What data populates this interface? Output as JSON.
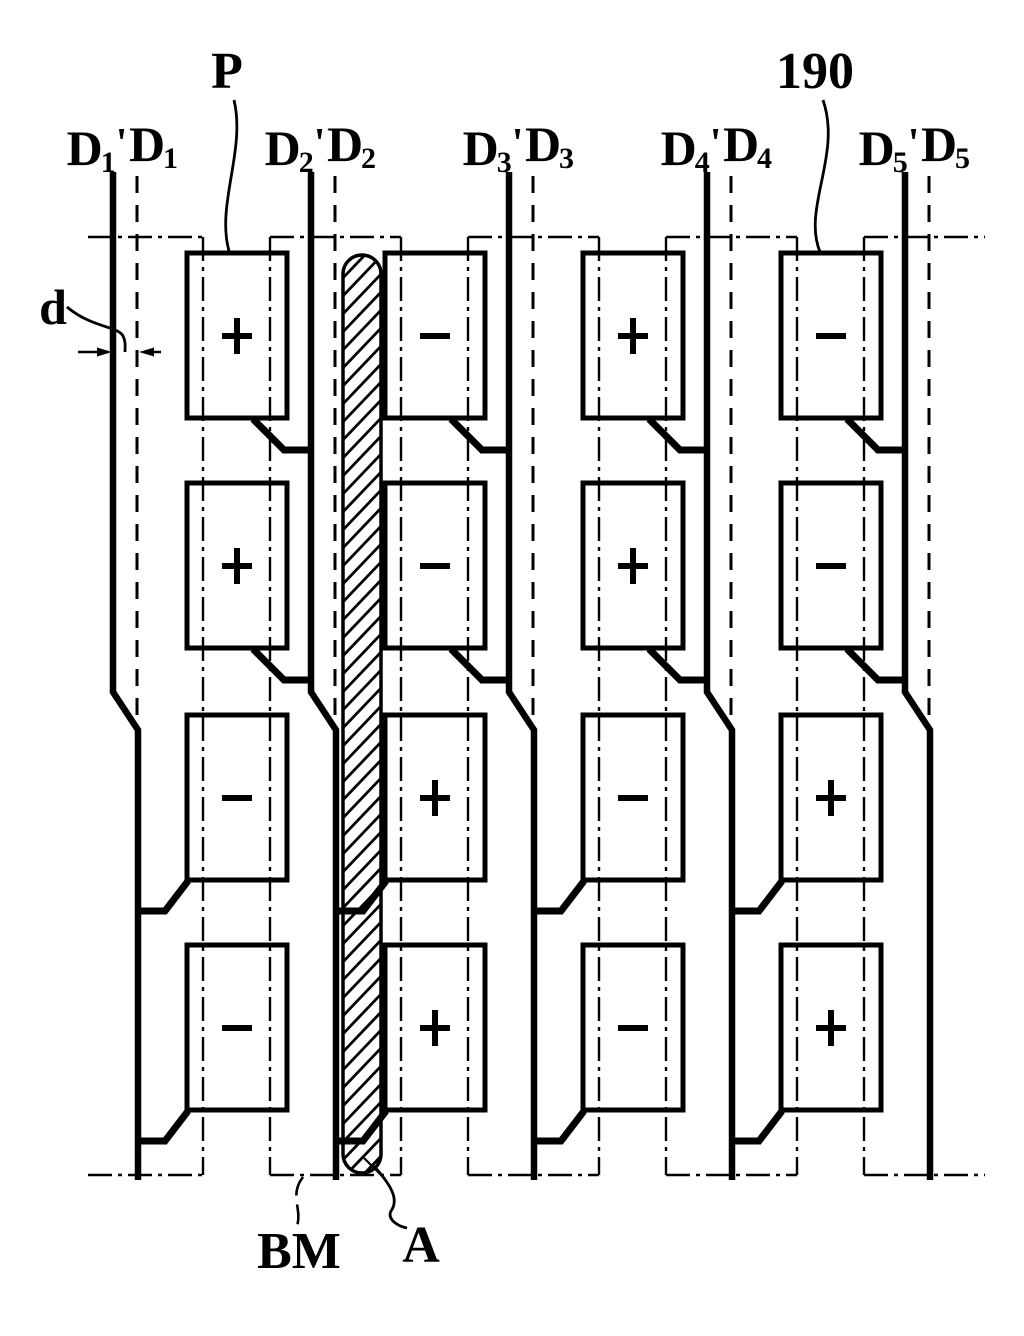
{
  "colors": {
    "ink": "#000000",
    "background": "#ffffff"
  },
  "data_lines": {
    "base_symbol": "D",
    "prime_mark": "'",
    "pair_indices": [
      "1",
      "2",
      "3",
      "4",
      "5"
    ]
  },
  "annotations": {
    "pixel_label": "P",
    "reference_label": "190",
    "gap_label": "d",
    "black_matrix_label": "BM",
    "area_label": "A"
  },
  "pixel_grid": {
    "rows": 4,
    "columns": 4,
    "polarity": [
      [
        "+",
        "−",
        "+",
        "−"
      ],
      [
        "+",
        "−",
        "+",
        "−"
      ],
      [
        "−",
        "+",
        "−",
        "+"
      ],
      [
        "−",
        "+",
        "−",
        "+"
      ]
    ]
  }
}
